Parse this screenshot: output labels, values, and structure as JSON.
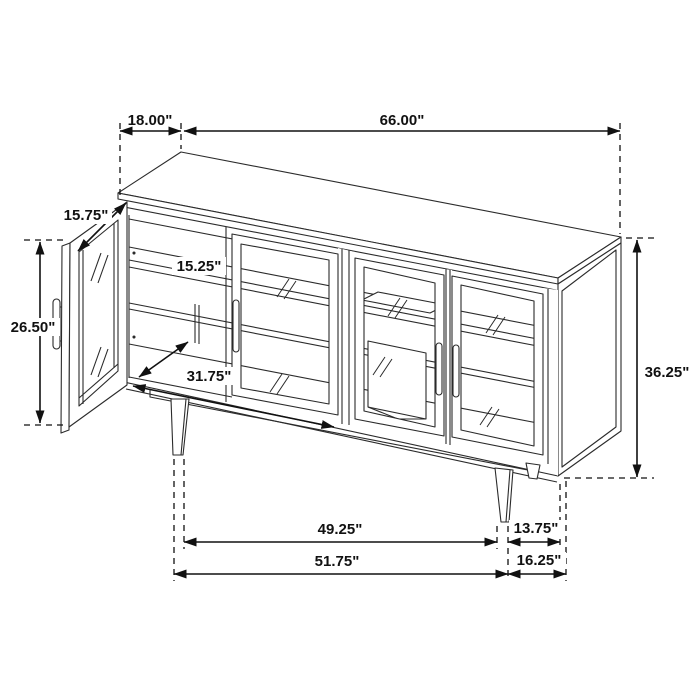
{
  "figure": {
    "type": "furniture-dimension-diagram",
    "subject": "sideboard cabinet with four glass doors, left door open, tapered legs",
    "unit": "inches",
    "view": "isometric line drawing with dimension callouts"
  },
  "colors": {
    "background": "#ffffff",
    "drawing_line": "#2b2b2b",
    "dimension_line": "#111111",
    "text": "#111111"
  },
  "dimensions": {
    "depth_top": {
      "label": "18.00\"",
      "meaning": "top depth"
    },
    "width_top": {
      "label": "66.00\"",
      "meaning": "overall width"
    },
    "door_width": {
      "label": "15.75\"",
      "meaning": "open door width"
    },
    "shelf_depth": {
      "label": "15.25\"",
      "meaning": "interior shelf depth"
    },
    "door_height": {
      "label": "26.50\"",
      "meaning": "door height"
    },
    "interior_width": {
      "label": "31.75\"",
      "meaning": "interior opening width"
    },
    "overall_height": {
      "label": "36.25\"",
      "meaning": "overall height"
    },
    "leg_span_inner": {
      "label": "49.25\"",
      "meaning": "inner leg spacing"
    },
    "leg_offset_right": {
      "label": "13.75\"",
      "meaning": "leg to right edge"
    },
    "leg_span_outer": {
      "label": "51.75\"",
      "meaning": "outer leg spacing"
    },
    "right_overhang": {
      "label": "16.25\"",
      "meaning": "leg to outer right edge"
    }
  }
}
